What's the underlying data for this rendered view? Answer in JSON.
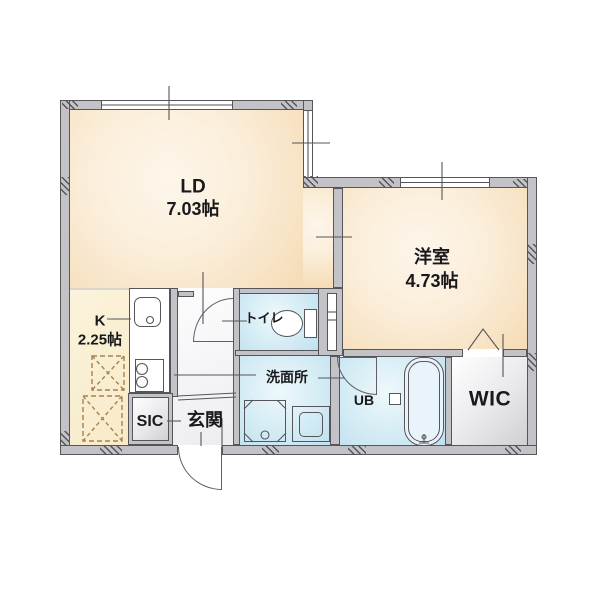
{
  "plan_title": "1LDK apartment floor plan",
  "rooms": {
    "living_dining": {
      "label": "LD",
      "size": "7.03帖"
    },
    "western_room": {
      "label": "洋室",
      "size": "4.73帖"
    },
    "kitchen": {
      "label": "K",
      "size": "2.25帖"
    },
    "toilet": {
      "label": "トイレ"
    },
    "washroom": {
      "label": "洗面所"
    },
    "unit_bath": {
      "label": "UB"
    },
    "walk_in_closet": {
      "label": "WIC"
    },
    "shoes_in_closet": {
      "label": "SIC"
    },
    "entrance": {
      "label": "玄関"
    }
  },
  "colors": {
    "wall_fill": "#c3c3c7",
    "wall_line": "#55555a",
    "room_peach": "#f5dbb5",
    "room_cream": "#f6e9c4",
    "room_blue": "#bfe1ef",
    "room_gray": "#cfcfd4",
    "dashed_appliance": "#a8824e",
    "text": "#19191c"
  },
  "icons": [
    "kitchen-sink-icon",
    "stove-icon",
    "toilet-icon",
    "bathtub-icon",
    "faucet-icon",
    "washing-machine-pan-icon",
    "vanity-icon",
    "entrance-door-arc",
    "ld-door-arc",
    "unit-bath-door-arc",
    "folding-door-icon",
    "appliance-space-dashed",
    "window-glyph"
  ]
}
